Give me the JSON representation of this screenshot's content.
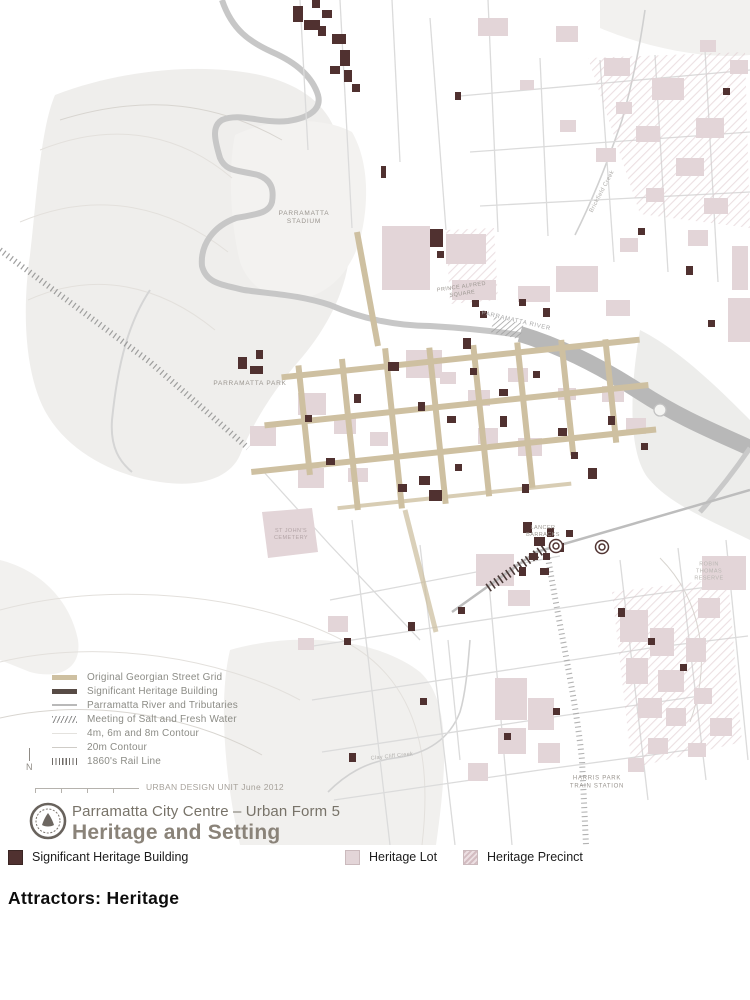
{
  "map": {
    "labels": {
      "stadium": [
        "PARRAMATTA",
        "STADIUM"
      ],
      "park": [
        "PARRAMATTA PARK"
      ],
      "river": [
        "PARRAMATTA RIVER"
      ],
      "prince_alfred": [
        "PRINCE ALFRED",
        "SQUARE"
      ],
      "lancer_barracks": [
        "LANCER",
        "BARRACKS"
      ],
      "st_johns_cemetery": [
        "ST JOHN'S",
        "CEMETERY"
      ],
      "robin_thomas_reserve": [
        "ROBIN",
        "THOMAS",
        "RESERVE"
      ],
      "harris_park_station": [
        "HARRIS PARK",
        "TRAIN STATION"
      ],
      "brickfield_creek": [
        "Brickfield Creek"
      ],
      "clay_cliff_creek": [
        "Clay Cliff Creek"
      ]
    },
    "legend": {
      "items": [
        {
          "label": "Original Georgian Street Grid"
        },
        {
          "label": "Significant Heritage Building"
        },
        {
          "label": "Parramatta River and Tributaries"
        },
        {
          "label": "Meeting of Salt and Fresh Water"
        },
        {
          "label": "4m, 6m and 8m Contour"
        },
        {
          "label": "20m Contour"
        },
        {
          "label": "1860's Rail Line"
        }
      ]
    },
    "north_label": "N",
    "credit": "URBAN DESIGN UNIT June 2012",
    "title_line1": "Parramatta City Centre – Urban Form 5",
    "title_line2": "Heritage and Setting"
  },
  "bottom_legend": {
    "items": [
      {
        "label": "Significant Heritage Building"
      },
      {
        "label": "Heritage Lot"
      },
      {
        "label": "Heritage Precinct"
      }
    ]
  },
  "caption": "Attractors: Heritage",
  "colors": {
    "heritage_building": "#503130",
    "heritage_lot": "#e3d5d8",
    "street_grid": "#cec0a1",
    "river": "#bfbfbf",
    "park": "#efeeec",
    "rail": "#9a9a9a"
  }
}
